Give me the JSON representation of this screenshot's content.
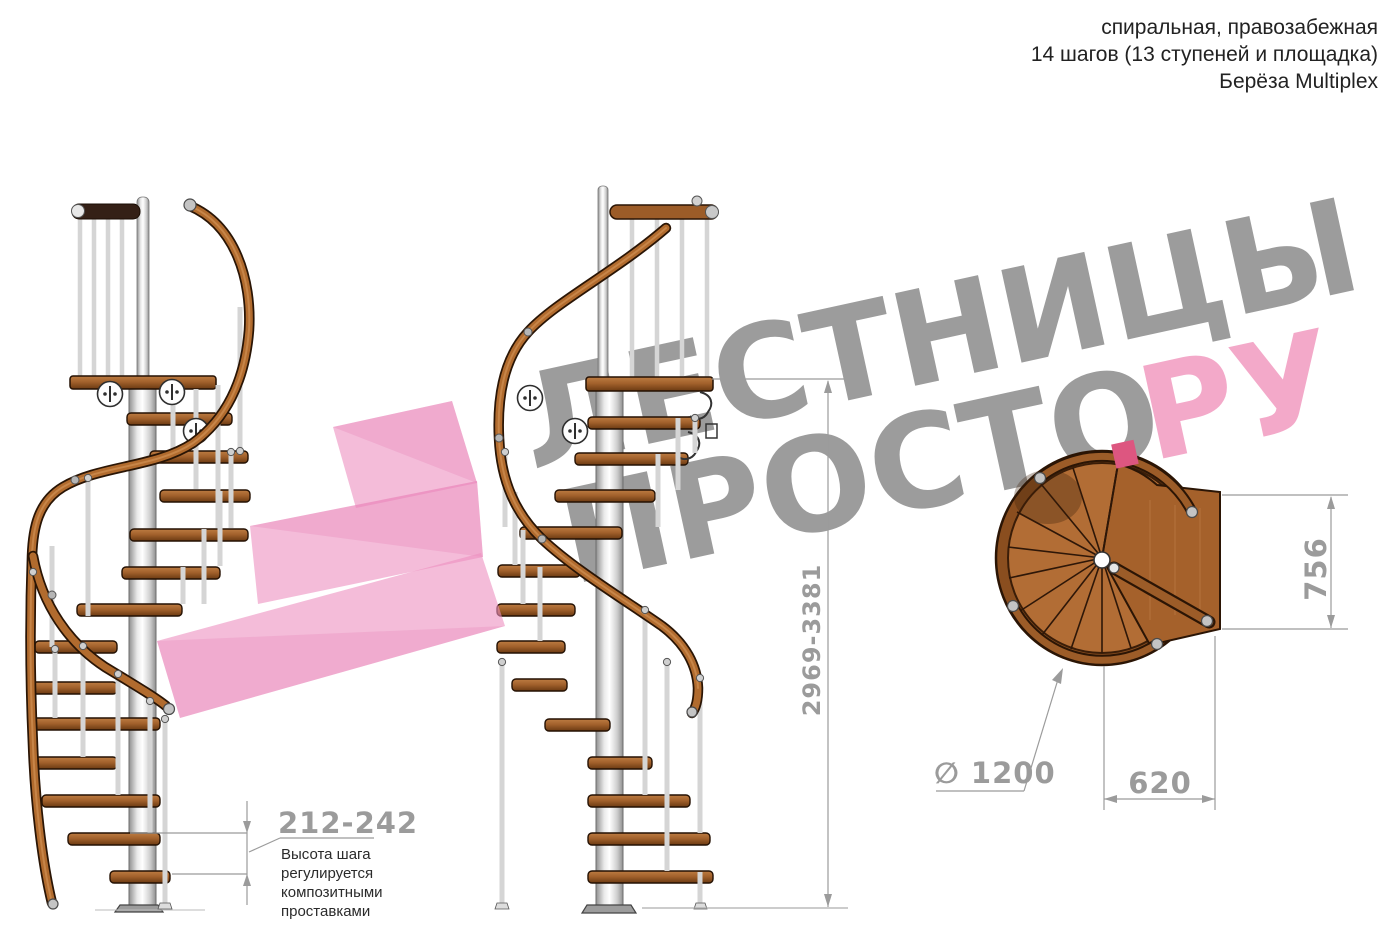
{
  "header": {
    "line1": "спиральная, правозабежная",
    "line2": "14 шагов (13 ступеней и площадка)",
    "line3": "Берёза Multiplex"
  },
  "watermark": {
    "line1": "ЛЕСТНИЦЫ",
    "line2": "ПРОСТО",
    "suffix_dot": ".",
    "suffix": "РУ",
    "gray_color": "#9c9c9c",
    "pink_color": "#f3a9c9",
    "dot_color": "#dd5680",
    "ribbon_color": "#ec8fc0"
  },
  "dimensions": {
    "total_height": "2969-3381",
    "landing_depth": "756",
    "step_width": "620",
    "diameter": "∅ 1200",
    "step_height_range": "212-242"
  },
  "note": {
    "text": "Высота шага\nрегулируется\nкомпозитными\nпроставками"
  },
  "drawing": {
    "wood_color": "#a9682f",
    "rail_color": "#b16b2e",
    "pole_color": "#e8e8e8",
    "dim_line_color": "#9b9b9b"
  }
}
